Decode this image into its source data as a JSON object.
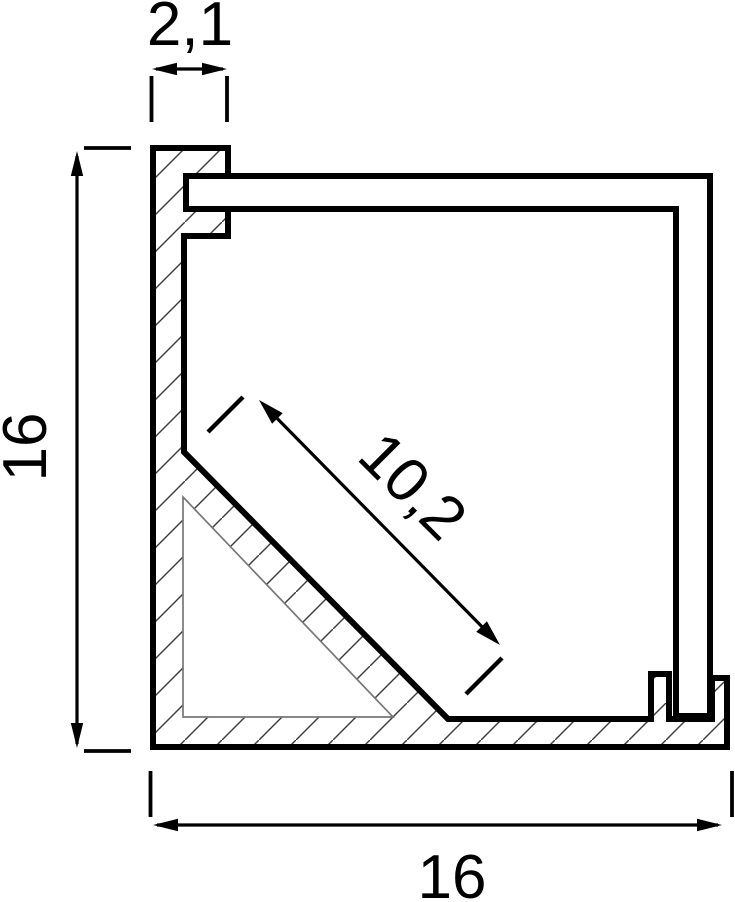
{
  "figure": {
    "dimensions": {
      "top_width": "2,1",
      "left_height": "16",
      "bottom_width": "16",
      "diagonal_opening": "10,2"
    },
    "colors": {
      "line": "#000000",
      "hatch_line": "#3f3f3f",
      "hollow_outline": "#777777",
      "background": "#ffffff",
      "profile_fill": "#ffffff"
    }
  }
}
